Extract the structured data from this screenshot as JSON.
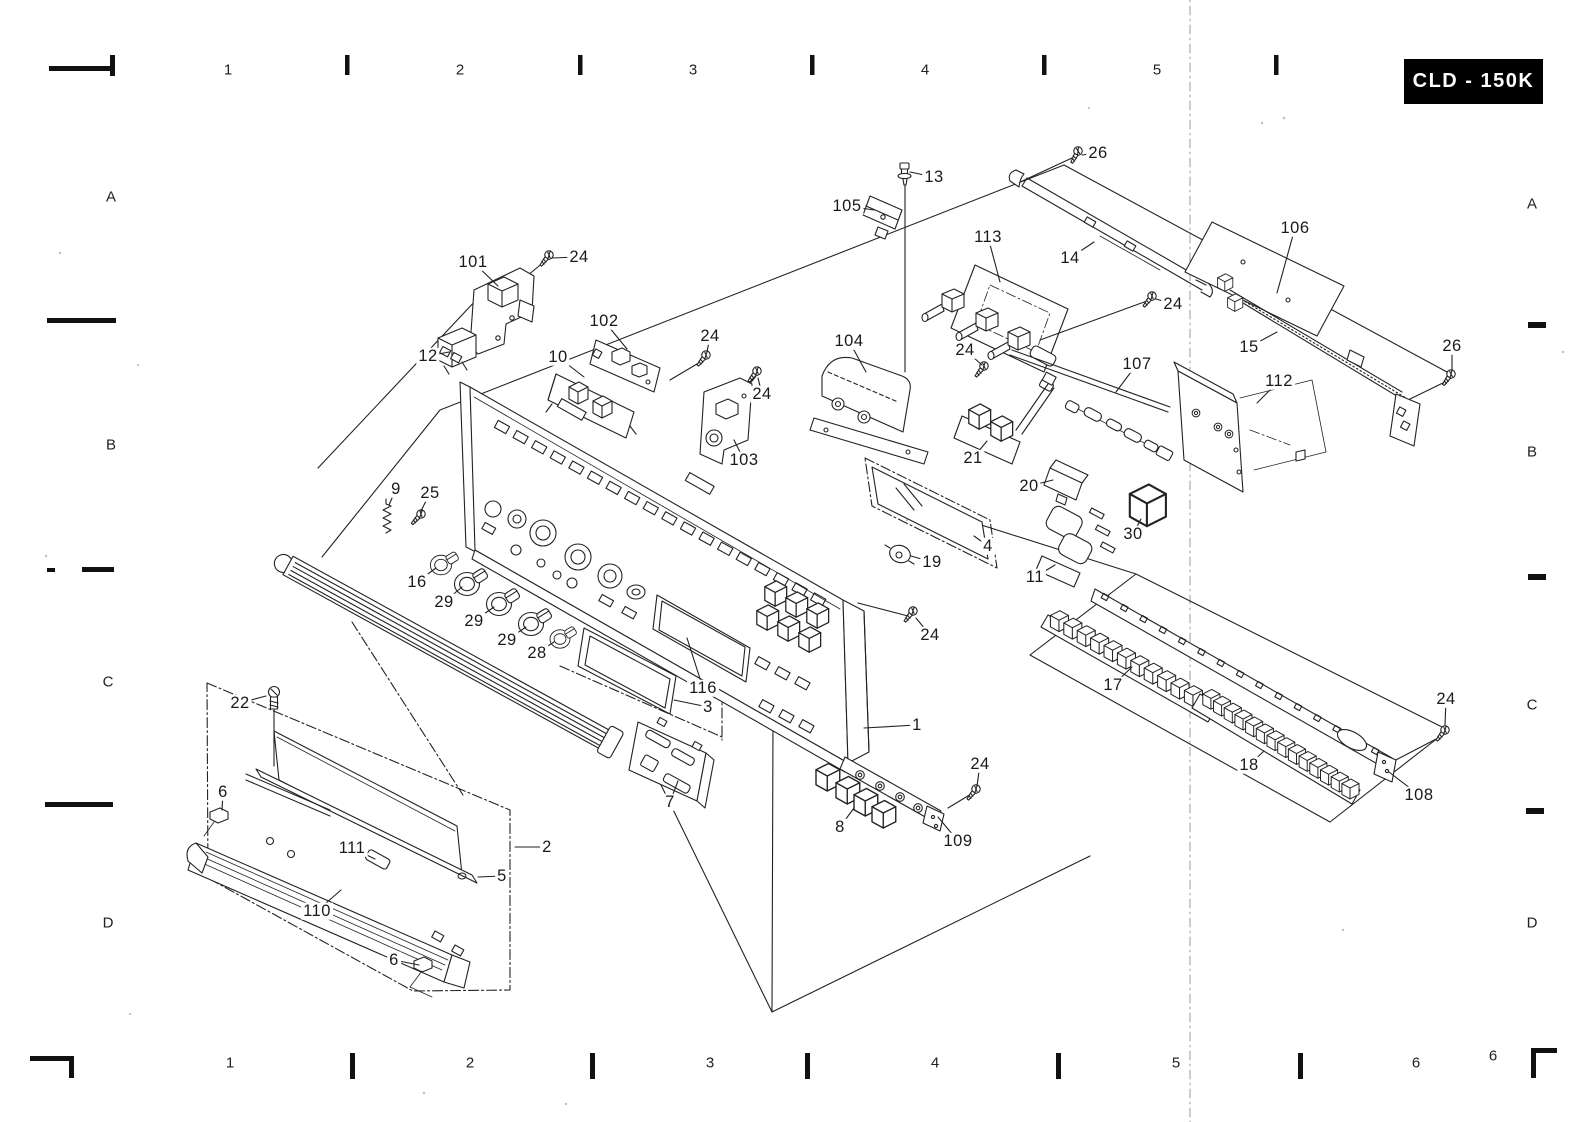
{
  "page": {
    "paper_color": "#ffffff",
    "ink_color": "#1a1a1a"
  },
  "title_block": {
    "model": "CLD - 150K",
    "bg": "#000000",
    "fg": "#ffffff"
  },
  "grid": {
    "top": [
      {
        "text": "1",
        "x": 228,
        "y": 70
      },
      {
        "text": "2",
        "x": 460,
        "y": 70
      },
      {
        "text": "3",
        "x": 693,
        "y": 70
      },
      {
        "text": "4",
        "x": 925,
        "y": 70
      },
      {
        "text": "5",
        "x": 1157,
        "y": 70
      }
    ],
    "bottom": [
      {
        "text": "1",
        "x": 230,
        "y": 1063
      },
      {
        "text": "2",
        "x": 470,
        "y": 1063
      },
      {
        "text": "3",
        "x": 710,
        "y": 1063
      },
      {
        "text": "4",
        "x": 935,
        "y": 1063
      },
      {
        "text": "5",
        "x": 1176,
        "y": 1063
      },
      {
        "text": "6",
        "x": 1416,
        "y": 1063
      },
      {
        "text": "6",
        "x": 1493,
        "y": 1056
      }
    ],
    "left": [
      {
        "text": "A",
        "x": 111,
        "y": 197
      },
      {
        "text": "B",
        "x": 111,
        "y": 445
      },
      {
        "text": "C",
        "x": 108,
        "y": 682
      },
      {
        "text": "D",
        "x": 108,
        "y": 923
      }
    ],
    "right": [
      {
        "text": "A",
        "x": 1532,
        "y": 204
      },
      {
        "text": "B",
        "x": 1532,
        "y": 452
      },
      {
        "text": "C",
        "x": 1532,
        "y": 705
      },
      {
        "text": "D",
        "x": 1532,
        "y": 923
      }
    ]
  },
  "callouts": [
    {
      "label": "26",
      "x": 1098,
      "y": 153,
      "tx": 1082,
      "ty": 155
    },
    {
      "label": "13",
      "x": 934,
      "y": 177,
      "tx": 910,
      "ty": 172
    },
    {
      "label": "105",
      "x": 847,
      "y": 206,
      "tx": 874,
      "ty": 210
    },
    {
      "label": "113",
      "x": 988,
      "y": 237,
      "tx": 1000,
      "ty": 282
    },
    {
      "label": "14",
      "x": 1070,
      "y": 258,
      "tx": 1094,
      "ty": 242
    },
    {
      "label": "106",
      "x": 1295,
      "y": 228,
      "tx": 1277,
      "ty": 293
    },
    {
      "label": "24",
      "x": 1173,
      "y": 304,
      "tx": 1156,
      "ty": 299
    },
    {
      "label": "104",
      "x": 849,
      "y": 341,
      "tx": 866,
      "ty": 372
    },
    {
      "label": "24",
      "x": 965,
      "y": 350,
      "tx": 982,
      "ty": 365
    },
    {
      "label": "107",
      "x": 1137,
      "y": 364,
      "tx": 1116,
      "ty": 392
    },
    {
      "label": "15",
      "x": 1249,
      "y": 347,
      "tx": 1277,
      "ty": 332
    },
    {
      "label": "112",
      "x": 1279,
      "y": 381,
      "tx": 1257,
      "ty": 403
    },
    {
      "label": "26",
      "x": 1452,
      "y": 346,
      "tx": 1452,
      "ty": 371
    },
    {
      "label": "101",
      "x": 473,
      "y": 262,
      "tx": 498,
      "ty": 286
    },
    {
      "label": "24",
      "x": 579,
      "y": 257,
      "tx": 552,
      "ty": 258
    },
    {
      "label": "12",
      "x": 428,
      "y": 356,
      "tx": 449,
      "ty": 352
    },
    {
      "label": "102",
      "x": 604,
      "y": 321,
      "tx": 627,
      "ty": 349
    },
    {
      "label": "10",
      "x": 558,
      "y": 357,
      "tx": 584,
      "ty": 377
    },
    {
      "label": "24",
      "x": 710,
      "y": 336,
      "tx": 707,
      "ty": 352
    },
    {
      "label": "24",
      "x": 762,
      "y": 394,
      "tx": 758,
      "ty": 378
    },
    {
      "label": "103",
      "x": 744,
      "y": 460,
      "tx": 734,
      "ty": 440
    },
    {
      "label": "9",
      "x": 396,
      "y": 489,
      "tx": 389,
      "ty": 505
    },
    {
      "label": "25",
      "x": 430,
      "y": 493,
      "tx": 421,
      "ty": 511
    },
    {
      "label": "16",
      "x": 417,
      "y": 582,
      "tx": 436,
      "ty": 568
    },
    {
      "label": "29",
      "x": 444,
      "y": 602,
      "tx": 462,
      "ty": 587
    },
    {
      "label": "29",
      "x": 474,
      "y": 621,
      "tx": 494,
      "ty": 607
    },
    {
      "label": "29",
      "x": 507,
      "y": 640,
      "tx": 526,
      "ty": 627
    },
    {
      "label": "28",
      "x": 537,
      "y": 653,
      "tx": 554,
      "ty": 642
    },
    {
      "label": "22",
      "x": 240,
      "y": 703,
      "tx": 266,
      "ty": 696
    },
    {
      "label": "6",
      "x": 223,
      "y": 792,
      "tx": 222,
      "ty": 810
    },
    {
      "label": "111",
      "x": 352,
      "y": 848,
      "tx": 375,
      "ty": 859
    },
    {
      "label": "2",
      "x": 547,
      "y": 847,
      "tx": 515,
      "ty": 847
    },
    {
      "label": "5",
      "x": 502,
      "y": 876,
      "tx": 478,
      "ty": 877
    },
    {
      "label": "110",
      "x": 317,
      "y": 911,
      "tx": 341,
      "ty": 890
    },
    {
      "label": "6",
      "x": 394,
      "y": 960,
      "tx": 419,
      "ty": 965
    },
    {
      "label": "116",
      "x": 703,
      "y": 688,
      "tx": 687,
      "ty": 638
    },
    {
      "label": "3",
      "x": 708,
      "y": 707,
      "tx": 674,
      "ty": 700
    },
    {
      "label": "1",
      "x": 917,
      "y": 725,
      "tx": 864,
      "ty": 728
    },
    {
      "label": "24",
      "x": 930,
      "y": 635,
      "tx": 916,
      "ty": 618
    },
    {
      "label": "7",
      "x": 670,
      "y": 802,
      "tx": 678,
      "ty": 781
    },
    {
      "label": "8",
      "x": 840,
      "y": 827,
      "tx": 854,
      "ty": 808
    },
    {
      "label": "24",
      "x": 980,
      "y": 764,
      "tx": 977,
      "ty": 786
    },
    {
      "label": "109",
      "x": 958,
      "y": 841,
      "tx": 938,
      "ty": 817
    },
    {
      "label": "21",
      "x": 973,
      "y": 458,
      "tx": 987,
      "ty": 441
    },
    {
      "label": "20",
      "x": 1029,
      "y": 486,
      "tx": 1053,
      "ty": 480
    },
    {
      "label": "30",
      "x": 1133,
      "y": 534,
      "tx": 1141,
      "ty": 519
    },
    {
      "label": "4",
      "x": 988,
      "y": 546,
      "tx": 974,
      "ty": 536
    },
    {
      "label": "19",
      "x": 932,
      "y": 562,
      "tx": 911,
      "ty": 556
    },
    {
      "label": "11",
      "x": 1035,
      "y": 577,
      "tx": 1055,
      "ty": 565
    },
    {
      "label": "17",
      "x": 1113,
      "y": 685,
      "tx": 1132,
      "ty": 667
    },
    {
      "label": "18",
      "x": 1249,
      "y": 765,
      "tx": 1264,
      "ty": 751
    },
    {
      "label": "24",
      "x": 1446,
      "y": 699,
      "tx": 1445,
      "ty": 725
    },
    {
      "label": "108",
      "x": 1419,
      "y": 795,
      "tx": 1389,
      "ty": 772
    }
  ]
}
